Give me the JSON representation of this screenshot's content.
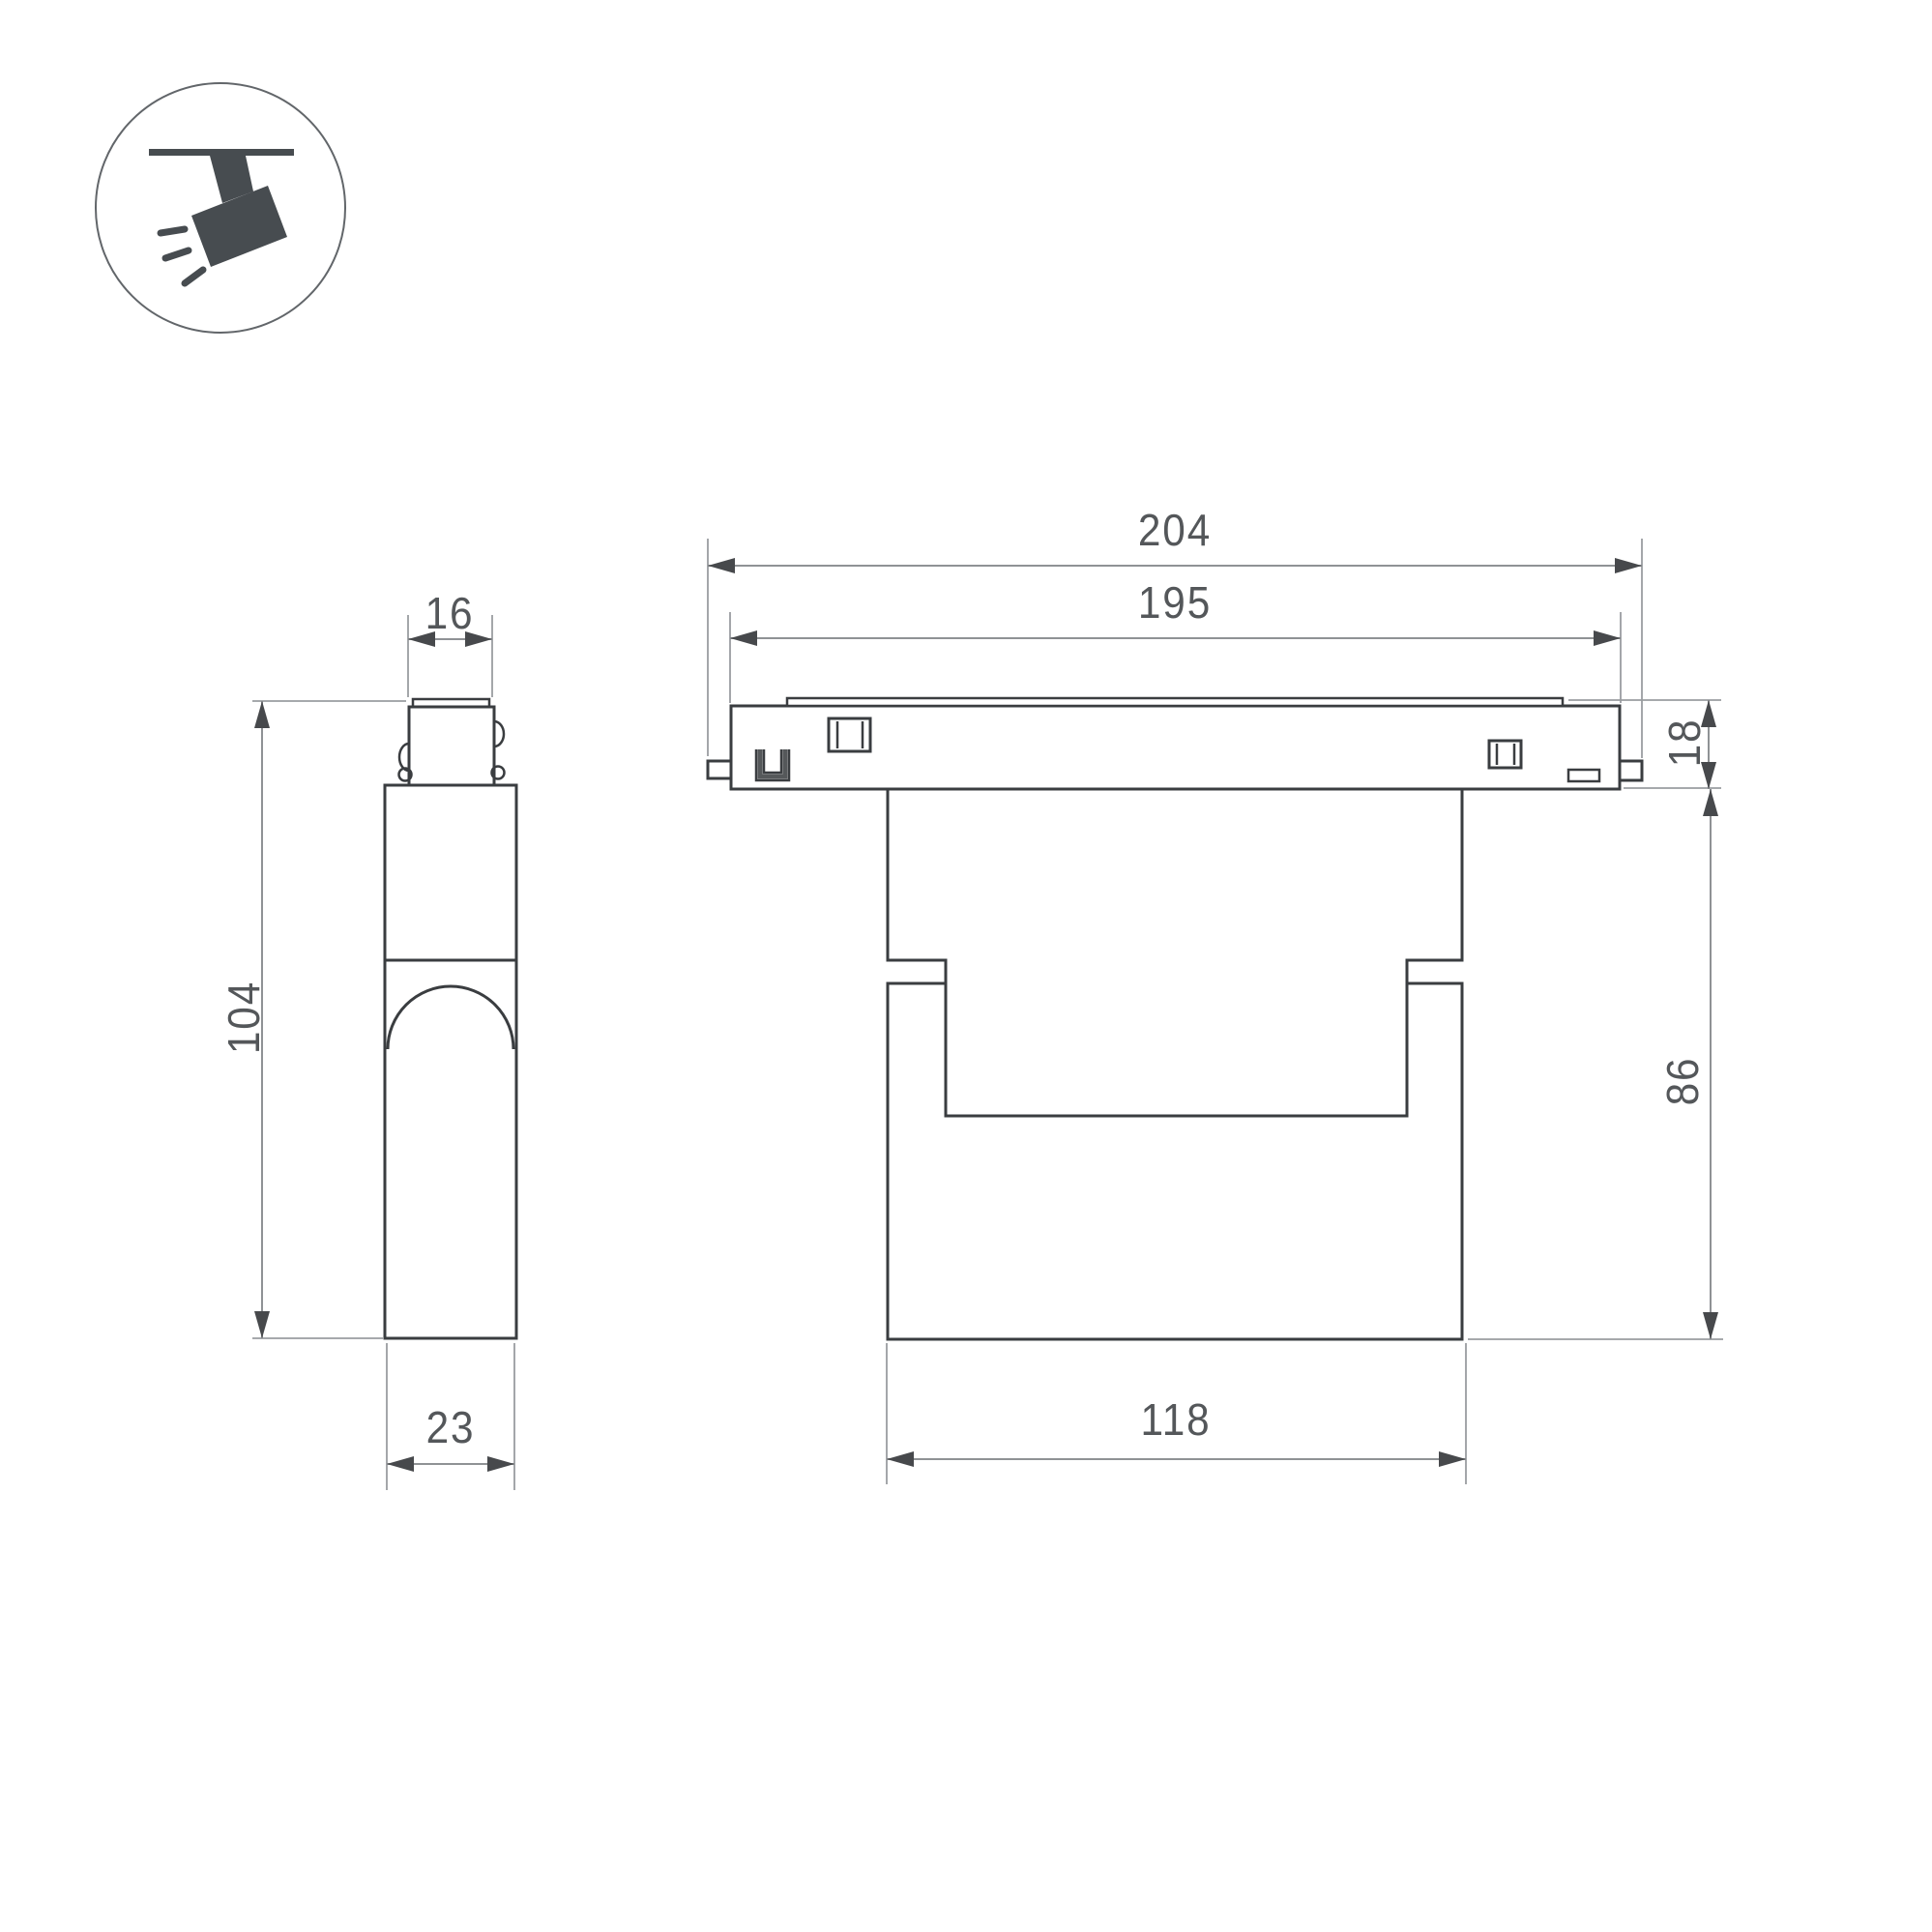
{
  "icon": {
    "name": "track-spotlight-icon",
    "description": "ceiling track with tilted spotlight emitting light rays"
  },
  "views": {
    "side_view": "side-profile-view",
    "front_view": "front-elevation-view"
  },
  "dimensions": {
    "overall_width": "204",
    "rail_width": "195",
    "adapter_width": "16",
    "rail_height": "18",
    "side_total_height": "104",
    "body_height": "86",
    "side_depth": "23",
    "body_width": "118"
  },
  "colors": {
    "background": "#ffffff",
    "object_line": "#3a3d40",
    "dimension_line": "#8f9295",
    "extension_line": "#9a9da0",
    "arrow": "#47494c",
    "label_text": "#54575a",
    "icon_fill": "#474c50",
    "icon_circle_stroke": "#62666a"
  }
}
